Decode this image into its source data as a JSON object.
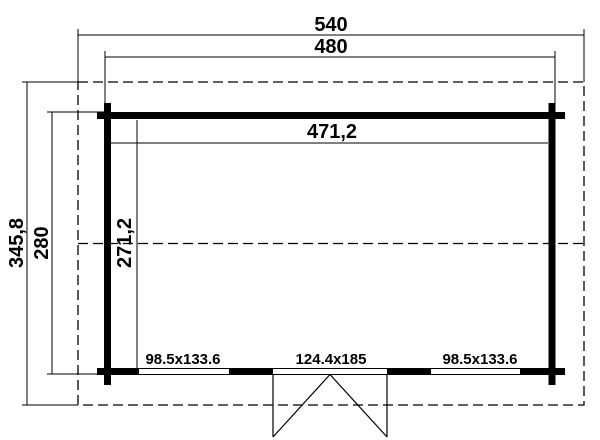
{
  "drawing": {
    "type": "floor-plan",
    "colors": {
      "line": "#000000",
      "background": "#ffffff"
    },
    "dimensions": {
      "overall_width": "540",
      "frame_width": "480",
      "inner_width": "471,2",
      "overall_depth": "345,8",
      "frame_depth": "280",
      "inner_depth": "271,2"
    },
    "openings": {
      "window_left": "98.5x133.6",
      "door": "124.4x185",
      "window_right": "98.5x133.6"
    }
  }
}
